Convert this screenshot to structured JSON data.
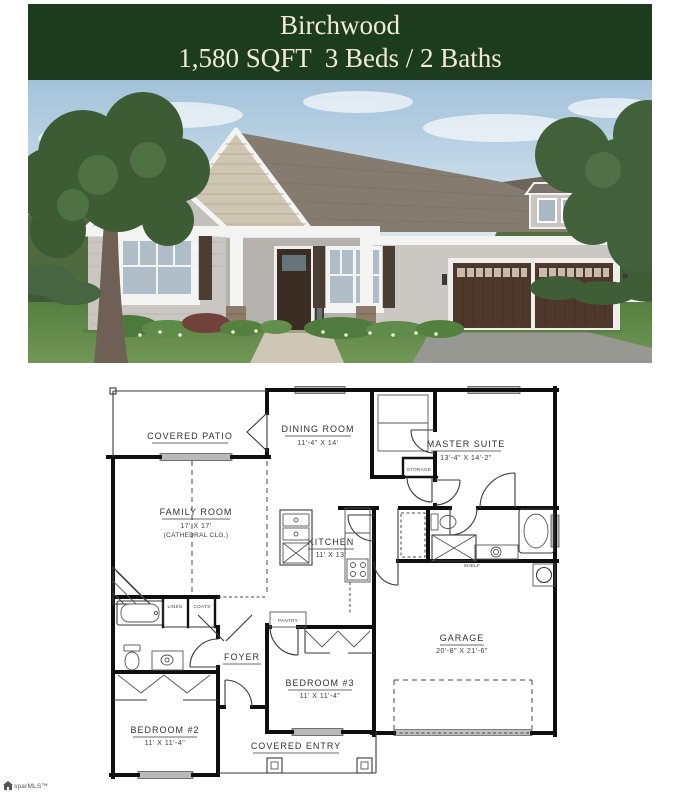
{
  "header": {
    "title": "Birchwood",
    "subtitle": "1,580 SQFT  3 Beds / 2 Baths",
    "bg_color": "#1d3c1d",
    "text_color": "#f0ead9"
  },
  "photo": {
    "subject": "front-exterior-rendering-of-single-story-house",
    "palette": {
      "sky": "#a3c2da",
      "grass": "#5d8745",
      "siding": "#cac6c1",
      "roof": "#857c6f",
      "gable_shake": "#cfc5b3",
      "shutters": "#4a3d32",
      "garage_door": "#4e382b",
      "trim": "#f4f4f2",
      "driveway": "#989893"
    }
  },
  "floor_plan": {
    "rooms": [
      {
        "name": "COVERED PATIO",
        "dims": ""
      },
      {
        "name": "DINING ROOM",
        "dims": "11'-4\" X 14'"
      },
      {
        "name": "MASTER SUITE",
        "dims": "13'-4\" X 14'-2\""
      },
      {
        "name": "FAMILY ROOM",
        "dims": "17' X 17'",
        "note": "(CATHEDRAL CLG.)"
      },
      {
        "name": "KITCHEN",
        "dims": "11' X 13'"
      },
      {
        "name": "GARAGE",
        "dims": "20'-8\" X 21'-6\""
      },
      {
        "name": "FOYER",
        "dims": ""
      },
      {
        "name": "BEDROOM #3",
        "dims": "11' X 11'-4\""
      },
      {
        "name": "BEDROOM #2",
        "dims": "11' X 11'-4\""
      },
      {
        "name": "COVERED ENTRY",
        "dims": ""
      }
    ],
    "closets": {
      "storage": "STORAGE",
      "linen": "LINEN",
      "coats": "COATS",
      "pantry": "PANTRY",
      "shelf": "SHELF"
    }
  },
  "watermark": {
    "text": "sparMLS™"
  }
}
